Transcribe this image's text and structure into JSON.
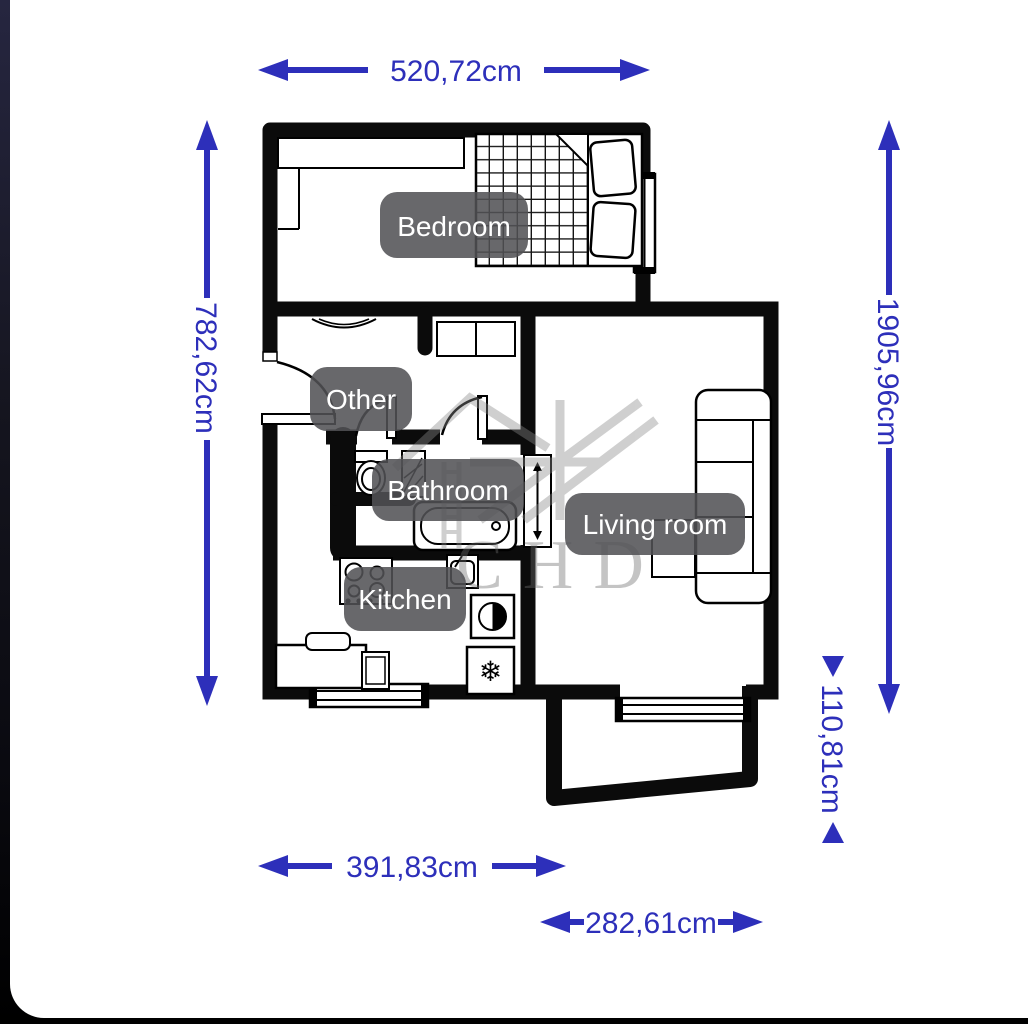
{
  "page": {
    "background_dark": "#14141f",
    "canvas_color": "#ffffff"
  },
  "floorplan": {
    "rooms": [
      {
        "id": "bedroom",
        "label": "Bedroom"
      },
      {
        "id": "other",
        "label": "Other"
      },
      {
        "id": "bathroom",
        "label": "Bathroom"
      },
      {
        "id": "living-room",
        "label": "Living room"
      },
      {
        "id": "kitchen",
        "label": "Kitchen"
      }
    ],
    "dimensions": {
      "top": "520,72cm",
      "left": "782,62cm",
      "right": "1905,96cm",
      "right_small": "110,81cm",
      "bottom_left": "391,83cm",
      "bottom_right": "282,61cm"
    },
    "colors": {
      "dimension_blue": "#2d2fba",
      "wall_black": "#0b0b0b",
      "label_chip": "#515155",
      "label_text": "#ffffff",
      "watermark_gray": "#8a8a8a"
    },
    "icons": {
      "freezer_snowflake": "❄"
    },
    "watermark_text": "CHD"
  }
}
